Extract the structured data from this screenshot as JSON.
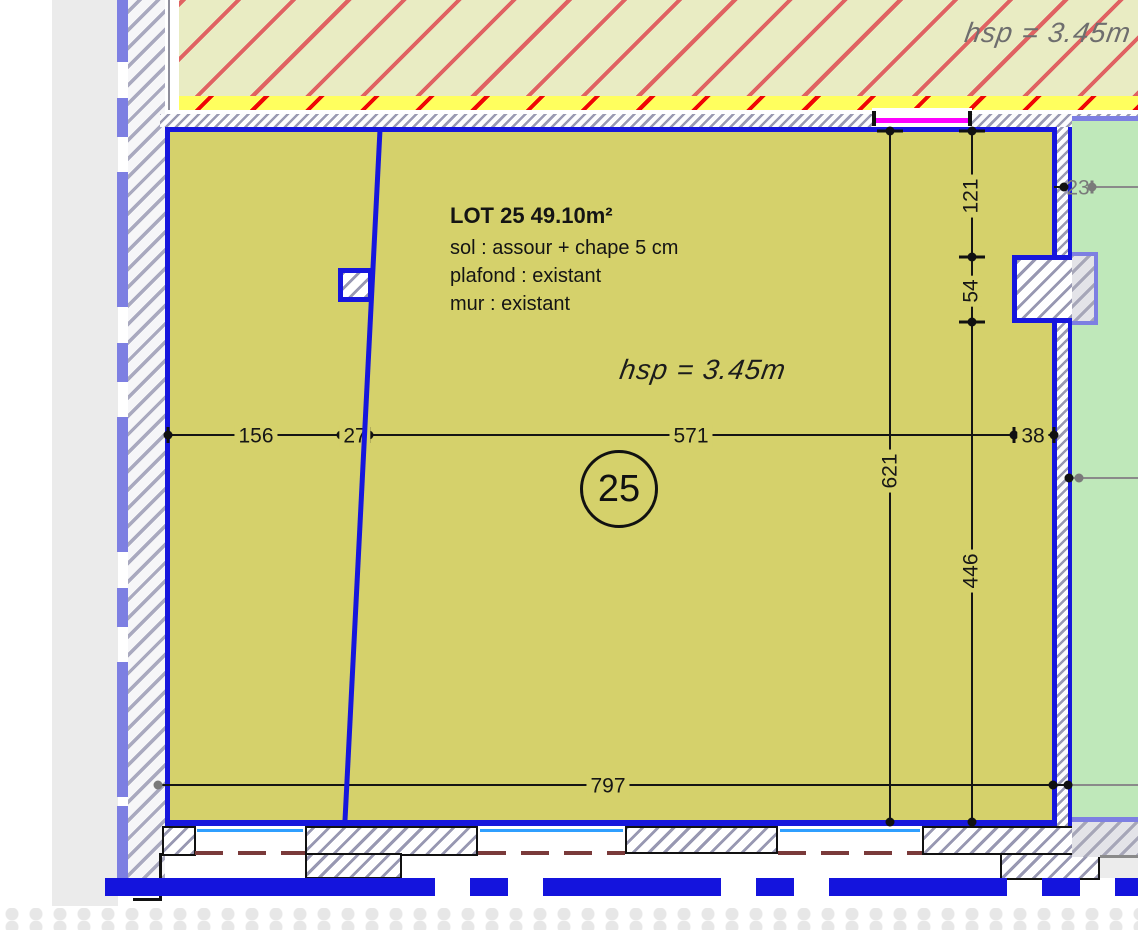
{
  "ceiling": {
    "height_label": "hsp = 3.45m"
  },
  "room": {
    "title": "LOT 25 49.10m²",
    "floor_spec": "sol : assour + chape 5 cm",
    "ceiling_spec": "plafond : existant",
    "wall_spec": "mur : existant",
    "height_label": "hsp = 3.45m",
    "number": "25"
  },
  "dims": {
    "d156": "156",
    "d27": "27",
    "d571": "571",
    "d38": "38",
    "d121": "121",
    "d54": "54",
    "d446": "446",
    "d621": "621",
    "d797": "797",
    "d23": "23"
  },
  "colors": {
    "room_fill": "#d5d16b",
    "wall_blue": "#1717dd",
    "green_fill": "#bfe8ba",
    "periwinkle": "#7d7fe2",
    "ceiling_fill": "#e9ecc3",
    "ceiling_hatch": "#e06262",
    "strip_yellow": "#ffff5e",
    "strip_hatch": "#ff0000",
    "magenta": "#ff00ff",
    "window_cyan": "#2f9fff",
    "door_dash_brown": "#7a3a3a",
    "outer_gray": "#ebebeb"
  }
}
